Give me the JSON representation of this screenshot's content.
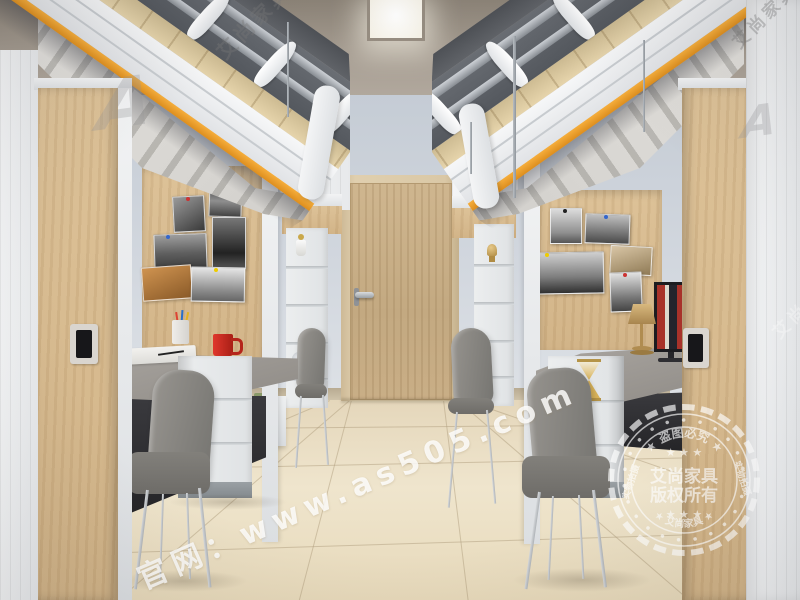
{
  "watermarks": {
    "site_url": "官网：www.as505.com",
    "brand": "艾尚家具",
    "brand_initial": "A"
  },
  "seal": {
    "arc_top": "★ 盗图必究 ★",
    "arc_bottom": "★ 艾尚家具 ★",
    "side_left": "实物拍摄",
    "side_right": "实物拍摄",
    "stars_row": "★ ★ ★",
    "center_line1": "艾尚家具",
    "center_line2": "版权所有"
  },
  "palette": {
    "accent_orange": "#f0a435",
    "wood_light": "#d8bd92",
    "door_wood": "#c6ad87",
    "wall_blue_gray": "#ccd3db",
    "ceiling_taupe": "#a0968b",
    "floor_beige": "#ecdfc5",
    "frame_white": "#eef0f2",
    "desk_gray": "#9e9a95",
    "chair_gray": "#86847f",
    "shadow_dark": "#39393c",
    "watermark_white": "#ffffff"
  }
}
